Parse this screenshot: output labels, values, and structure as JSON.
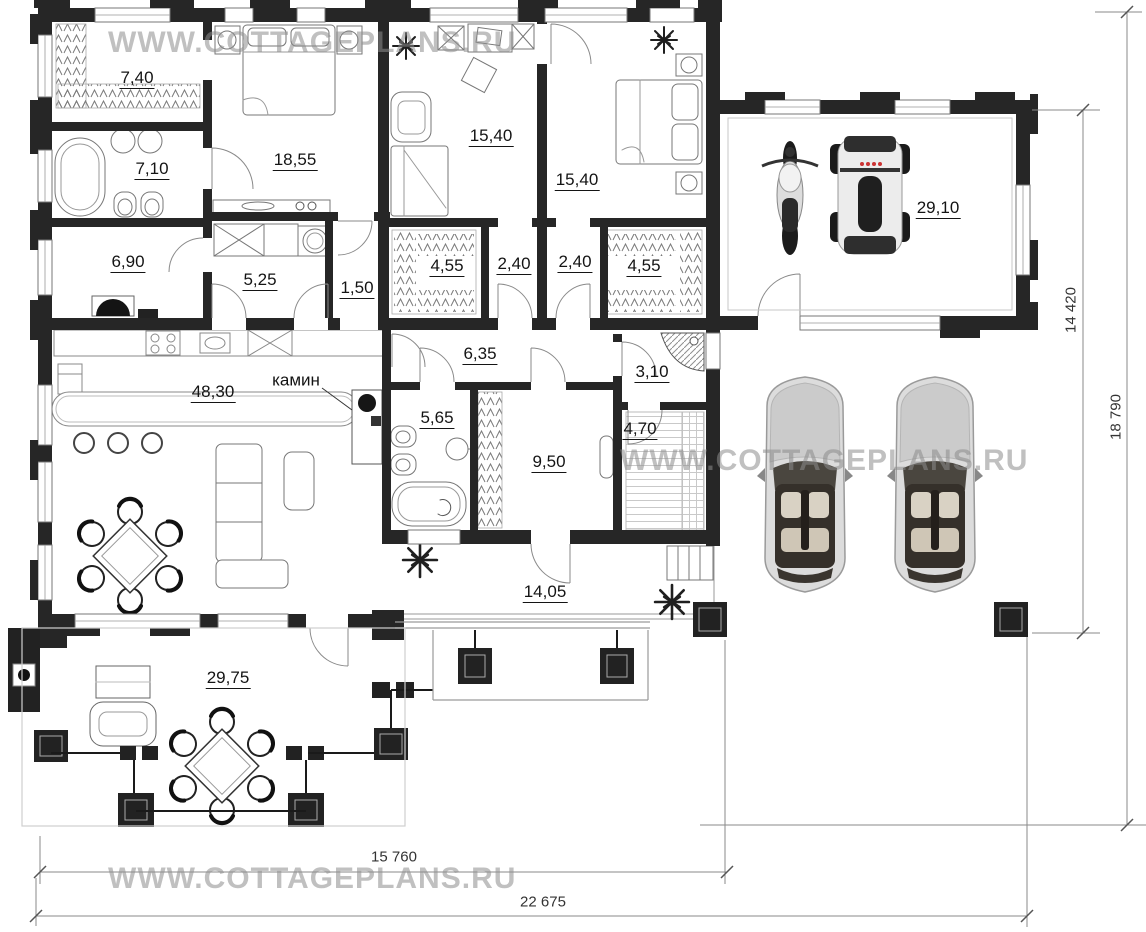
{
  "watermark": {
    "text": "WWW.COTTAGEPLANS.RU"
  },
  "labels": {
    "fireplace": "камин"
  },
  "rooms": [
    {
      "id": "wardrobe",
      "area": "7,40"
    },
    {
      "id": "bathroom-1",
      "area": "7,10"
    },
    {
      "id": "bedroom-1",
      "area": "18,55"
    },
    {
      "id": "bedroom-2",
      "area": "15,40"
    },
    {
      "id": "bedroom-3",
      "area": "15,40"
    },
    {
      "id": "garage",
      "area": "29,10"
    },
    {
      "id": "boiler-room",
      "area": "6,90"
    },
    {
      "id": "laundry",
      "area": "5,25"
    },
    {
      "id": "hall-small",
      "area": "1,50"
    },
    {
      "id": "closet-1",
      "area": "4,55"
    },
    {
      "id": "corridor-1",
      "area": "2,40"
    },
    {
      "id": "corridor-2",
      "area": "2,40"
    },
    {
      "id": "closet-2",
      "area": "4,55"
    },
    {
      "id": "hallway",
      "area": "6,35"
    },
    {
      "id": "shower-room",
      "area": "3,10"
    },
    {
      "id": "living-room",
      "area": "48,30"
    },
    {
      "id": "bathroom-2",
      "area": "5,65"
    },
    {
      "id": "dressing-room",
      "area": "9,50"
    },
    {
      "id": "sauna",
      "area": "4,70"
    },
    {
      "id": "terrace-back",
      "area": "14,05"
    },
    {
      "id": "terrace-front",
      "area": "29,75"
    }
  ],
  "dimensions": [
    {
      "id": "garage-side",
      "value": "14 420"
    },
    {
      "id": "plot-side",
      "value": "18 790"
    },
    {
      "id": "house-width",
      "value": "15 760"
    },
    {
      "id": "plot-width",
      "value": "22 675"
    }
  ]
}
